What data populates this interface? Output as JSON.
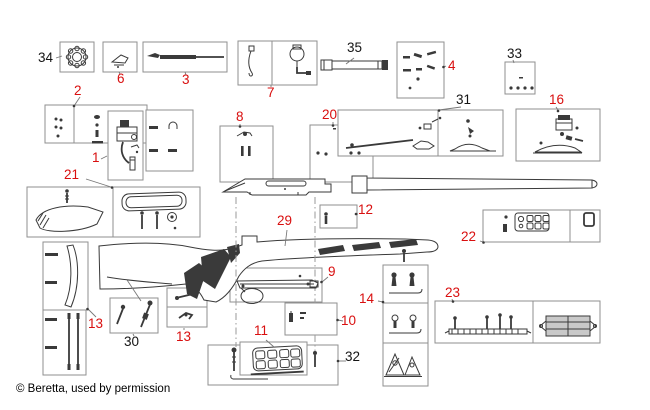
{
  "diagram": {
    "caption": "© Beretta, used by permission",
    "colors": {
      "red_label": "#d90f0f",
      "black_label": "#141414",
      "box_border": "#8f8f8f",
      "ink": "#3a3a3a"
    },
    "labels": {
      "p1": "1",
      "p2": "2",
      "p3": "3",
      "p4": "4",
      "p6": "6",
      "p7": "7",
      "p8": "8",
      "p9": "9",
      "p10": "10",
      "p11": "11",
      "p12": "12",
      "p13a": "13",
      "p13b": "13",
      "p14": "14",
      "p16": "16",
      "p20": "20",
      "p21": "21",
      "p22": "22",
      "p23": "23",
      "p29": "29",
      "p30": "30",
      "p31": "31",
      "p32": "32",
      "p33": "33",
      "p34": "34",
      "p35": "35"
    }
  }
}
